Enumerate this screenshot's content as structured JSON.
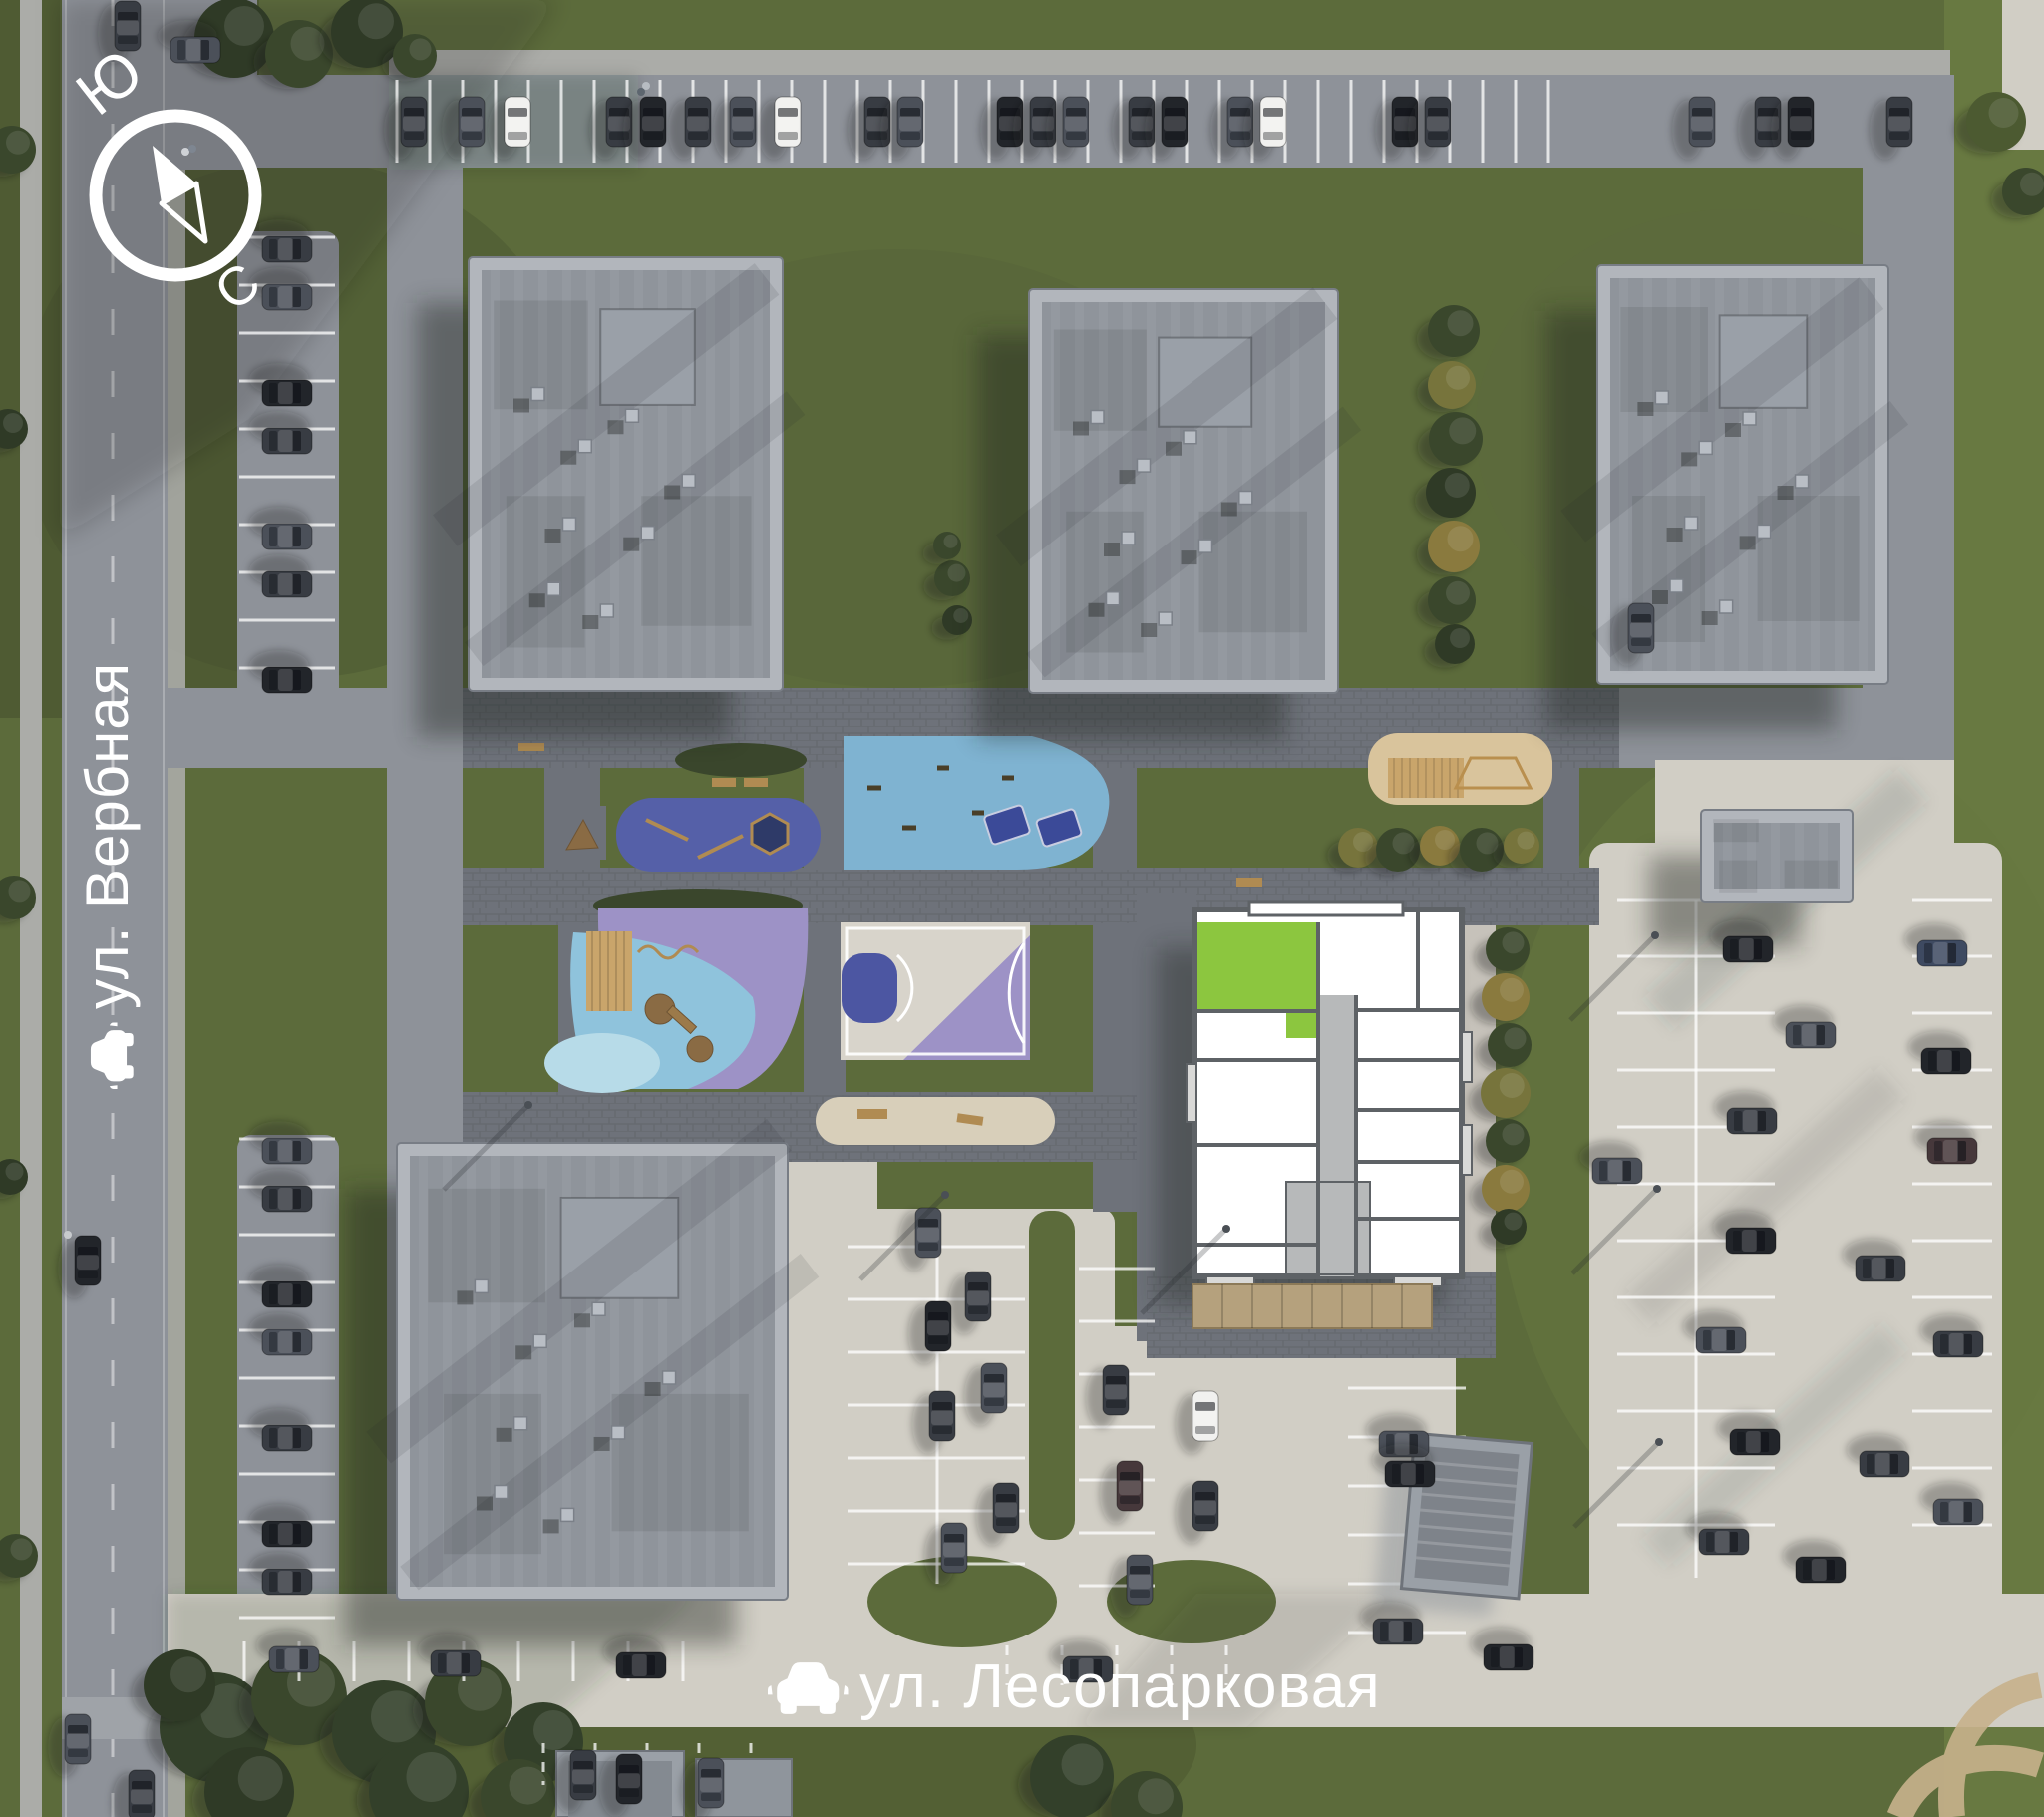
{
  "compass": {
    "south": "Ю",
    "north": "С"
  },
  "streets": {
    "left_vertical": {
      "label": "ул. Вербная"
    },
    "bottom_horizontal": {
      "label": "ул. Лесопарковая"
    }
  },
  "selected_apartment": {
    "highlight_color": "#8CC63F"
  },
  "colors": {
    "grass": "#5C6B3B",
    "grass_dark": "#49552F",
    "grass_bright": "#687941",
    "asphalt": "#8E9299",
    "paver": "#6E727A",
    "concrete": "#D1CEC5",
    "sidewalk": "#ABACA8",
    "roof_parapet": "#B2B6BC",
    "roof": "#8F949B",
    "wall": "#5E6266",
    "corridor": "#B7B9BA",
    "unit_white": "#FFFFFF",
    "accent_green": "#8CC63F",
    "play_blue": "#5560A8",
    "play_lightblue": "#7FB3D1",
    "play_toddler": "#8FC3DC",
    "play_purple": "#9D92C6",
    "court_blue": "#4C56A2",
    "court_base": "#D8D4CB",
    "sand": "#D9C49C",
    "wood": "#C9A56B",
    "tree": "#35402A",
    "label_white": "#FFFFFF",
    "car_palette": [
      "#383C43",
      "#4B5059",
      "#22252A",
      "#596069",
      "#F1F1EF",
      "#3E4A61",
      "#46383B"
    ]
  }
}
